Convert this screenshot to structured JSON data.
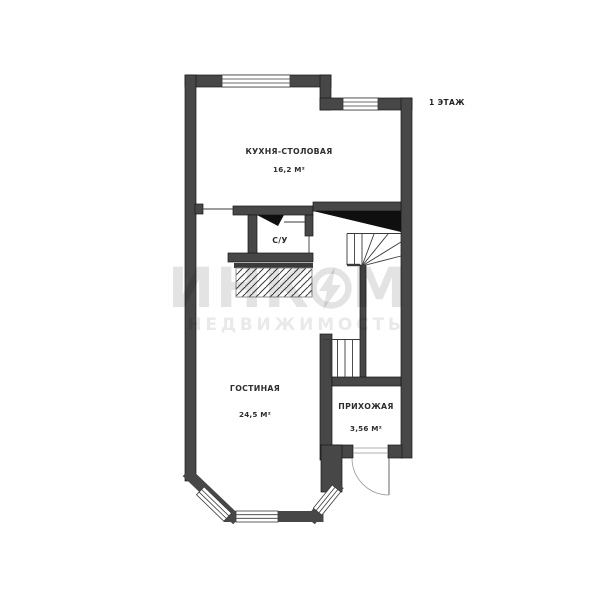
{
  "floor_label": "1 ЭТАЖ",
  "rooms": [
    {
      "name": "КУХНЯ-СТОЛОВАЯ",
      "area": "16,2 М²"
    },
    {
      "name": "С/У"
    },
    {
      "name": "ГОСТИНАЯ",
      "area": "24,5 М²"
    },
    {
      "name": "ПРИХОЖАЯ",
      "area": "3,56 М²"
    }
  ],
  "watermark": {
    "brand_full": "ИНКОМ",
    "brand_part1": "ИНК",
    "brand_part2": "М",
    "subtitle": "НЕДВИЖИМОСТЬ"
  },
  "colors": {
    "background": "#ffffff",
    "wall": "#474747",
    "wall_edge": "#161616",
    "thin_line": "#3a3a3a",
    "stair_shading": "#0f0f0f",
    "watermark_gray": "#e3e3e3"
  }
}
